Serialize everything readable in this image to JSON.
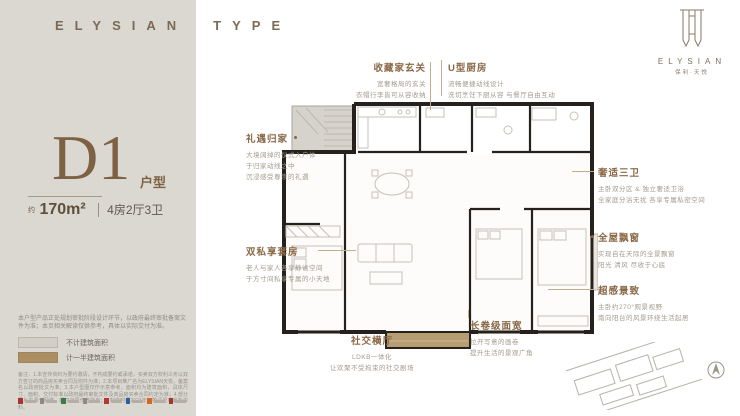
{
  "brand": {
    "wordmark_left": "ELYSIAN",
    "wordmark_right": "TYPE"
  },
  "logo": {
    "wordmark": "ELYSIAN",
    "sub_cn": "保利·天悦"
  },
  "unit": {
    "code": "D1",
    "code_label": "户型",
    "area_prefix": "约",
    "area": "170m²",
    "rooms": "4房2厅3卫"
  },
  "panel": {
    "note": "本户型产品正处规划审批阶段设计环节，以政府最终审批备案文件为准；本页相关解读仅供参考，具体以实际交付为准。",
    "legend": [
      {
        "label": "不计建筑面积",
        "color": "#d3cfc6"
      },
      {
        "label": "计一半建筑面积",
        "color": "#ac8e63"
      }
    ],
    "fine_print": "备注：1.本宣传资料为要约邀请，不构成要约或承诺，买卖双方权利义务以双方签订的商品房买卖合同及附件为准；2.本项目推广名为ELYSIAN天悦，备案名以政府批文为准；3.本户型图仅作示意参考，面积均为建筑面积，具体尺寸、面积、交付标准以政府最终审批文件及商品房买卖合同约定为准；4.部分图片来源于网络，版权归原作者所有；5.制作时间2023年，敬请留意最新资料。",
    "partner_colors": [
      "#a8352d",
      "#8f8a82",
      "#3c7a4a",
      "#8f8a82",
      "#b03a30",
      "#2e5fa3",
      "#d2691e",
      "#a8352d"
    ]
  },
  "annotations": {
    "foyer": {
      "title": "收藏家玄关",
      "l1": "宽奢格局的玄关",
      "l2": "衣帽行李皆可从容收纳"
    },
    "kitchen": {
      "title": "U型厨房",
      "l1": "流畅便捷动线设计",
      "l2": "洗切烹饪下厨从容 与餐厅自由互动"
    },
    "homecoming": {
      "title": "礼遇归家",
      "l1": "大境阔绰的仪式入户体",
      "l2": "于归家动线之中",
      "l3": "沉浸感受尊崇的礼遇"
    },
    "suites": {
      "title": "双私享套房",
      "l1": "老人与家人各享静谧空间",
      "l2": "于方寸间私享专属的小天地"
    },
    "baths": {
      "title": "奢适三卫",
      "l1": "主卧双分区 & 独立奢适卫浴",
      "l2": "全家庭分浴无扰 各享专属私密空间"
    },
    "bay": {
      "title": "全屋飘窗",
      "l1": "实现自在天际的全景飘窗",
      "l2": "阳光 清风 尽收于心底"
    },
    "view": {
      "title": "超感景致",
      "l1": "主卧约270°观景视野",
      "l2": "南向阳台的风景环绕生活起居"
    },
    "living": {
      "title": "社交横厅",
      "l1": "LDKB一体化",
      "l2": "让欢聚不受拘束的社交剧场"
    },
    "span": {
      "title": "长卷级面宽",
      "l1": "拉开写意的画卷",
      "l2": "提升生活的景观广角"
    }
  }
}
